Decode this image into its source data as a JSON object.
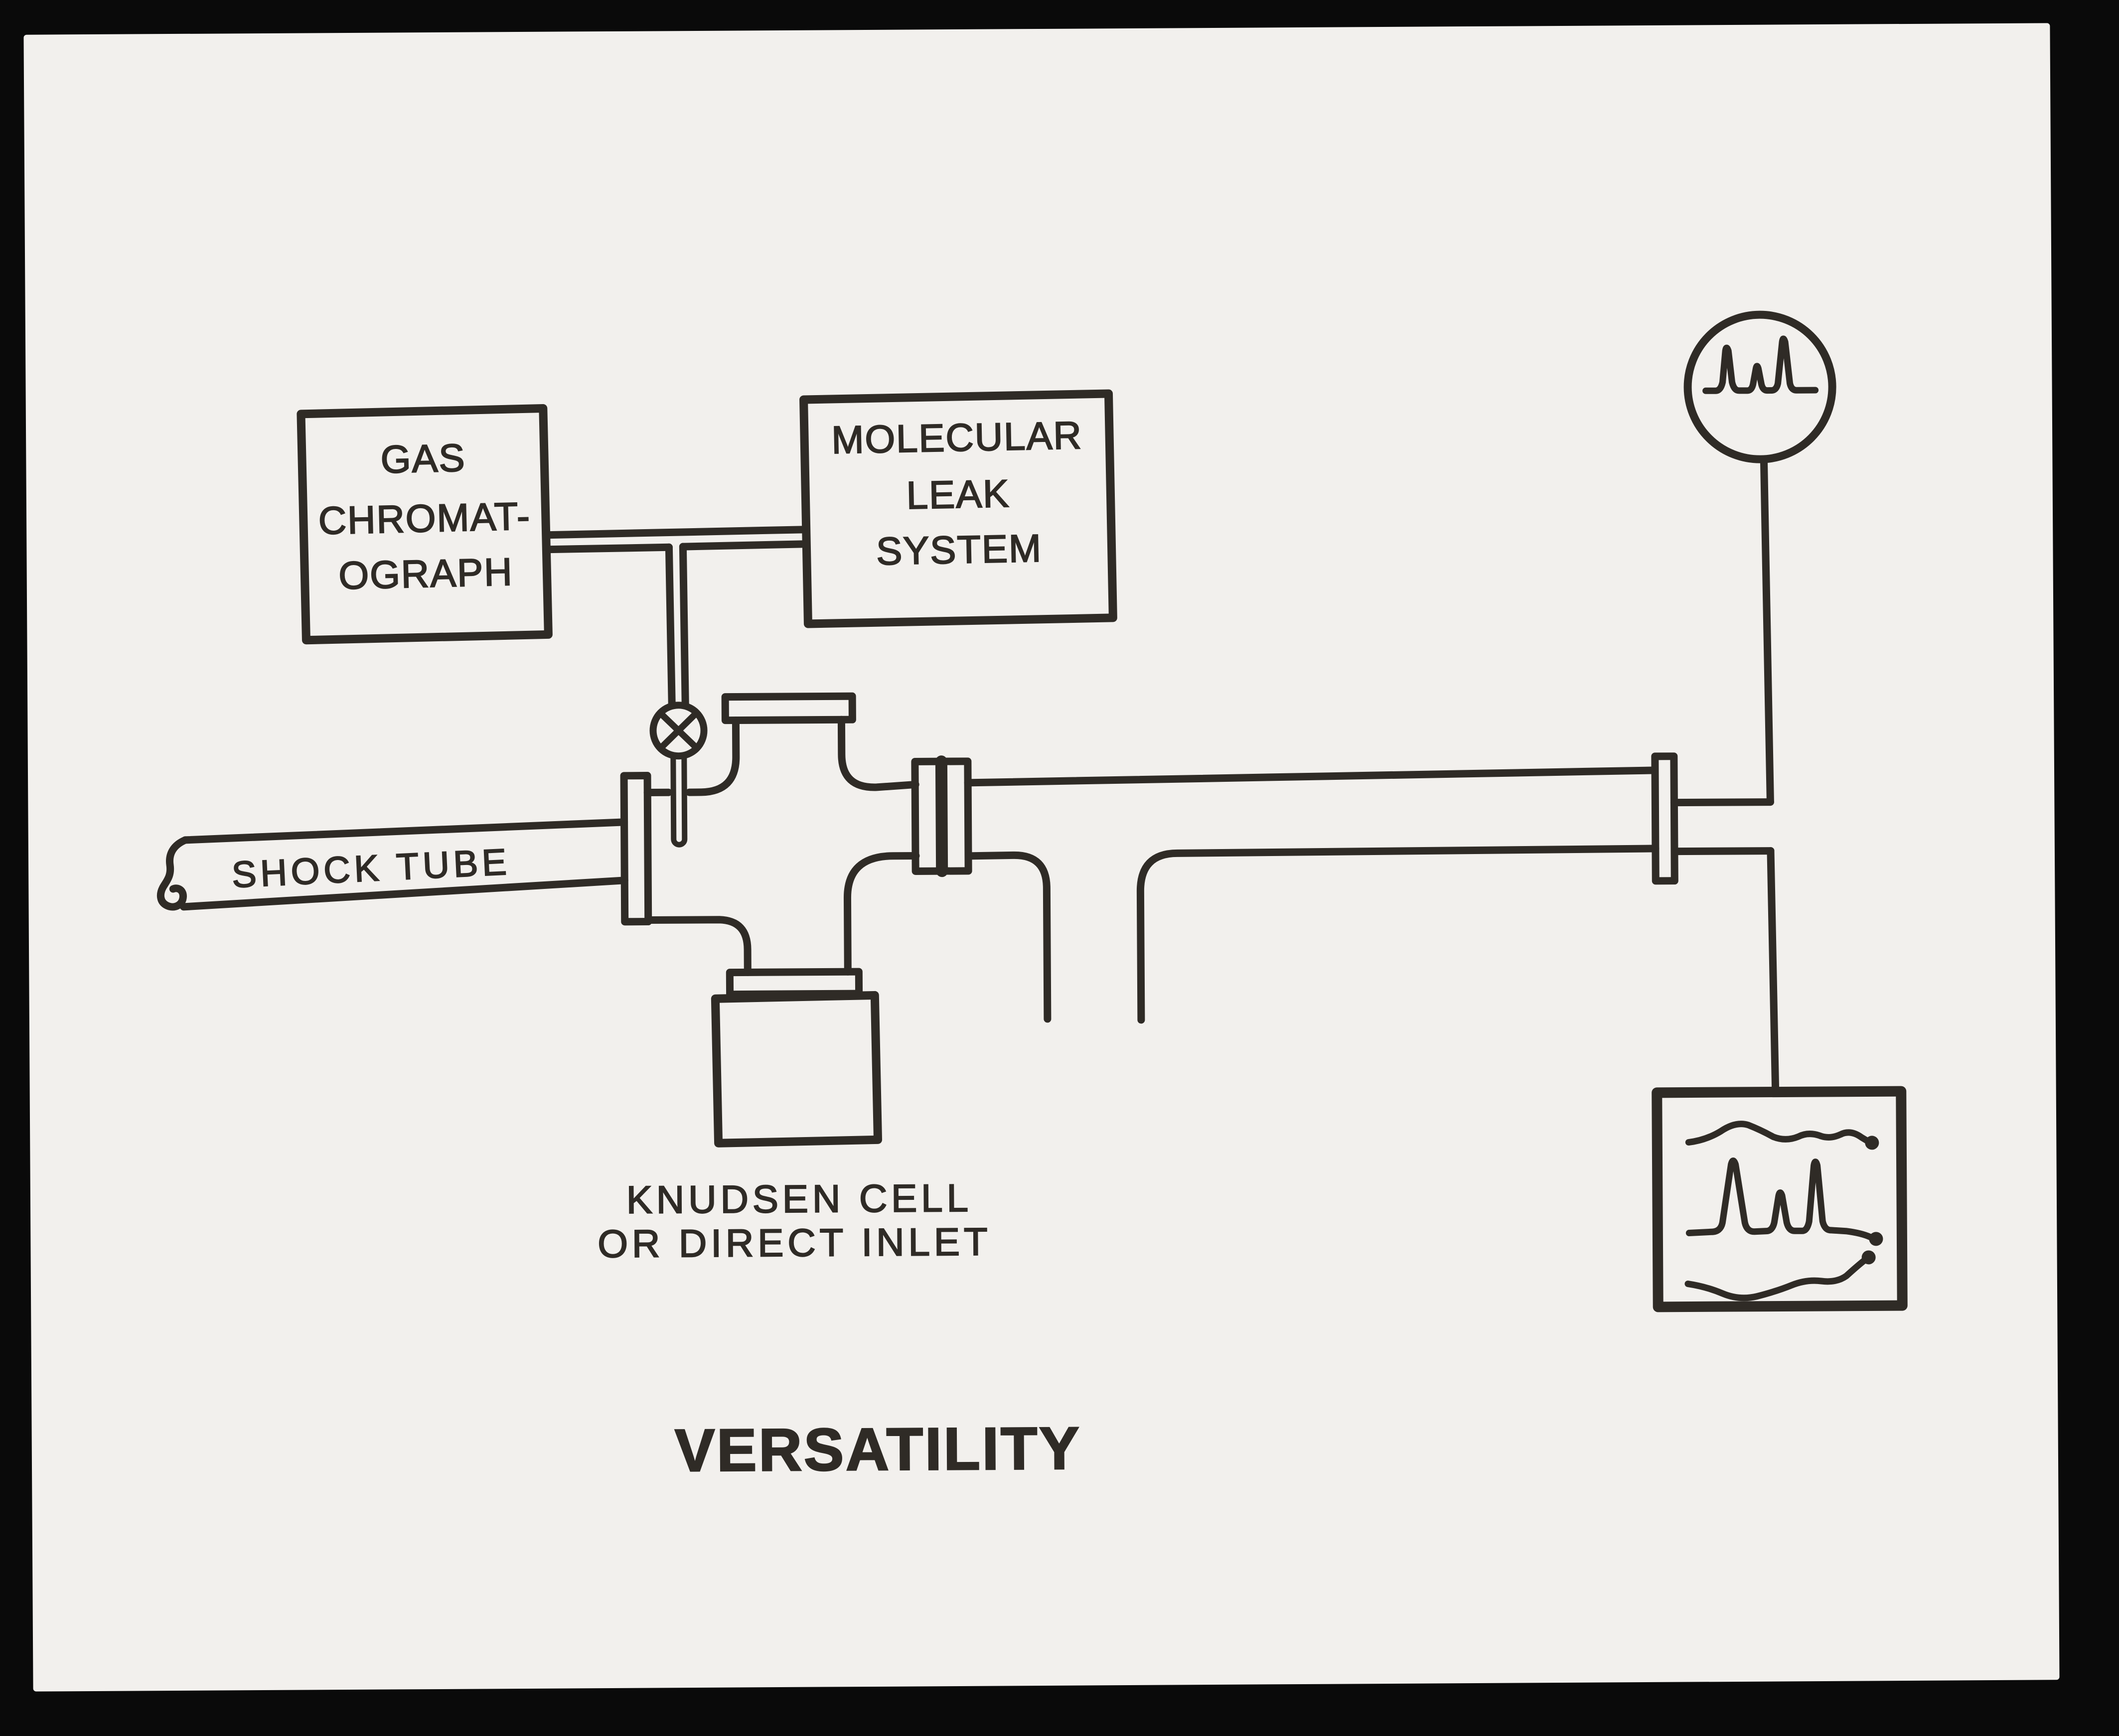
{
  "photo": {
    "background_color": "#0a0a0a",
    "card_color": "#f2f0ed",
    "ink_color": "#2f2b26",
    "description": "Hand-drawn instrument schematic photographed on a card"
  },
  "boxes": {
    "gas_chromatograph": {
      "lines": [
        "GAS",
        "CHROMAT-",
        "OGRAPH"
      ]
    },
    "molecular_leak_system": {
      "lines": [
        "MOLECULAR",
        "LEAK",
        "SYSTEM"
      ]
    }
  },
  "labels": {
    "shock_tube": "SHOCK TUBE",
    "inlet_line1": "KNUDSEN CELL",
    "inlet_line2": "OR DIRECT INLET",
    "caption": "VERSATILITY"
  },
  "symbols": {
    "valve": "valve-icon (circle with X)",
    "oscilloscope": "oscilloscope-display-icon (circle with mass peaks)",
    "recorder": "chart-recorder-icon (box with three pen traces)",
    "pump_port": "pump-port-opening",
    "flanges": "flange-plates"
  }
}
